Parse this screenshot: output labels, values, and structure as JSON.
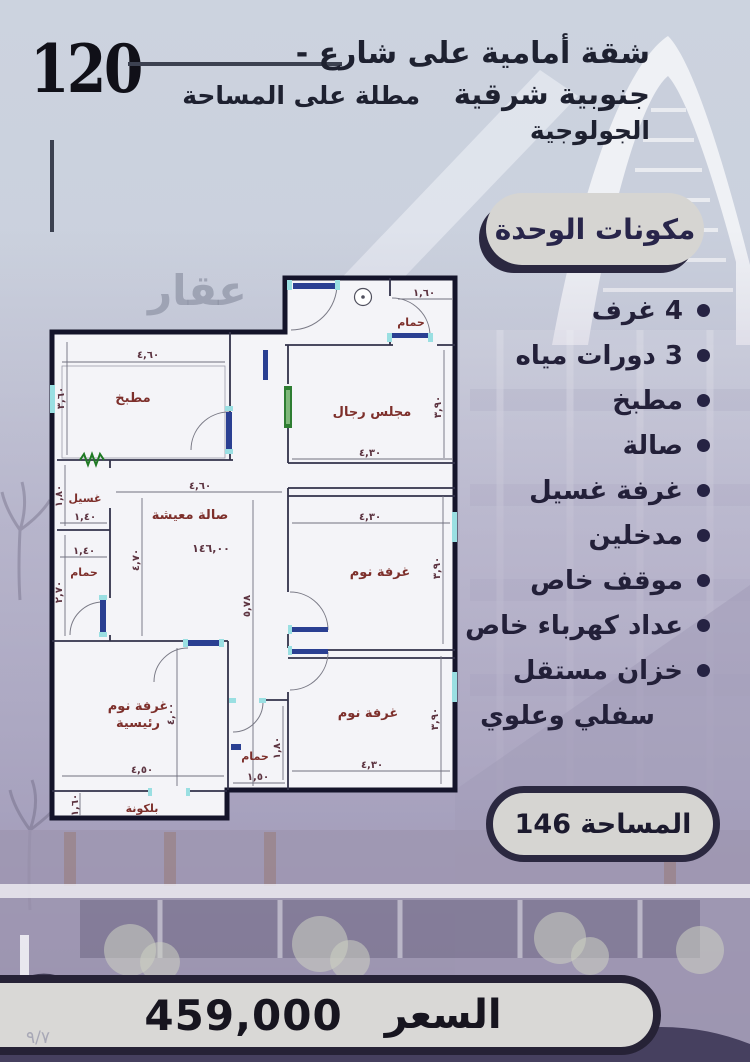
{
  "header": {
    "number": "120",
    "title_line1": "شقة أمامية على شارع -",
    "title_line2_right": "جنوبية شرقية",
    "title_line2_left": "مطلة على المساحة الجولوجية"
  },
  "watermark": "عقار",
  "components": {
    "badge": "مكونات الوحدة",
    "items": [
      {
        "label": "4 غرف"
      },
      {
        "label": "3 دورات مياه"
      },
      {
        "label": "مطبخ"
      },
      {
        "label": "صالة"
      },
      {
        "label": "غرفة غسيل"
      },
      {
        "label": "مدخلين"
      },
      {
        "label": "موقف خاص"
      },
      {
        "label": "عداد كهرباء خاص"
      },
      {
        "label": "خزان مستقل"
      },
      {
        "label": "سفلي وعلوي"
      }
    ]
  },
  "area_badge": {
    "label": "المساحة 146"
  },
  "price": {
    "label": "السعر",
    "value": "459,000"
  },
  "page_number": "٩/٧",
  "floor_plan": {
    "rooms": [
      {
        "name": "kitchen",
        "label": "مطبخ"
      },
      {
        "name": "laundry",
        "label": "غسيل"
      },
      {
        "name": "bath-left",
        "label": "حمام"
      },
      {
        "name": "living",
        "label": "صالة معيشة"
      },
      {
        "name": "majlis",
        "label": "مجلس رجال"
      },
      {
        "name": "bath-top",
        "label": "حمام"
      },
      {
        "name": "bedroom-mid",
        "label": "غرفة نوم"
      },
      {
        "name": "bedroom-bottom",
        "label": "غرفة نوم"
      },
      {
        "name": "bath-bottom",
        "label": "حمام"
      },
      {
        "name": "master-line1",
        "label": "غرفة نوم"
      },
      {
        "name": "master-line2",
        "label": "رئيسية"
      },
      {
        "name": "balcony",
        "label": "بلكونة"
      }
    ],
    "dims": [
      {
        "id": "kitchen-w",
        "label": "٤,٦٠"
      },
      {
        "id": "kitchen-h",
        "label": "٣,٦٠"
      },
      {
        "id": "bath-top-w",
        "label": "١,٦٠"
      },
      {
        "id": "majlis-w",
        "label": "٤,٣٠"
      },
      {
        "id": "majlis-h",
        "label": "٣,٩٠"
      },
      {
        "id": "living-w",
        "label": "٤,٦٠"
      },
      {
        "id": "living-h",
        "label": "٤,٧٠"
      },
      {
        "id": "living-area",
        "label": "١٤٦,٠٠"
      },
      {
        "id": "laundry-h",
        "label": "١,٨٠"
      },
      {
        "id": "laundry-w",
        "label": "١,٤٠"
      },
      {
        "id": "bath-left-w",
        "label": "١,٤٠"
      },
      {
        "id": "bath-left-h",
        "label": "٢,٧٠"
      },
      {
        "id": "corridor-h",
        "label": "٥,٧٨"
      },
      {
        "id": "bedroom-mid-w",
        "label": "٤,٣٠"
      },
      {
        "id": "bedroom-mid-h",
        "label": "٣,٩٠"
      },
      {
        "id": "bedroom-bottom-w",
        "label": "٤,٣٠"
      },
      {
        "id": "bedroom-bottom-h",
        "label": "٣,٩٠"
      },
      {
        "id": "bath-bottom-w",
        "label": "١,٥٠"
      },
      {
        "id": "bath-bottom-h",
        "label": "١,٨٠"
      },
      {
        "id": "master-w",
        "label": "٤,٥٠"
      },
      {
        "id": "master-h",
        "label": "٤,٠٠"
      },
      {
        "id": "balcony-h",
        "label": "١,٦٠"
      }
    ]
  },
  "colors": {
    "dark_navy": "#2b2840",
    "badge_fill": "#d6d5d2",
    "plan_label_red": "#7d2f2b",
    "lavender_wash": "#a79fbc",
    "sky": "#ccd2de"
  }
}
